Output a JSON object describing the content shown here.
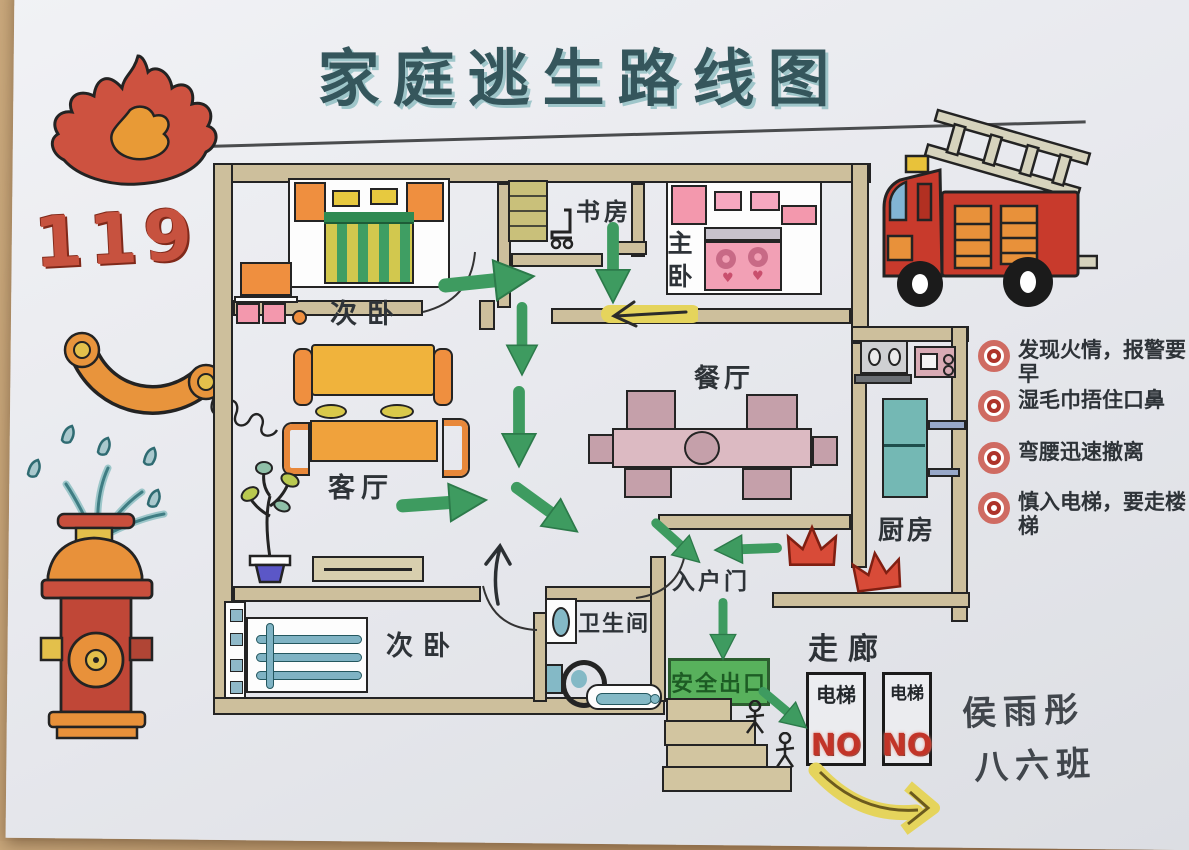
{
  "title": "家庭逃生路线图",
  "emergency_number": "119",
  "floor_plan": {
    "rooms": {
      "bedroom_top": "次卧",
      "study": "书房",
      "master_bedroom": "主卧",
      "living_room": "客厅",
      "dining_room": "餐厅",
      "kitchen": "厨房",
      "bedroom_bottom": "次卧",
      "bathroom": "卫生间",
      "entrance": "入户门",
      "corridor": "走廊"
    },
    "exit_sign": "安全出口",
    "elevators": [
      {
        "label": "电梯",
        "status": "NO"
      },
      {
        "label": "电梯",
        "status": "NO"
      }
    ]
  },
  "safety_tips": [
    "发现火情，报警要早",
    "湿毛巾捂住口鼻",
    "弯腰迅速撤离",
    "慎入电梯，要走楼梯"
  ],
  "signature": {
    "name": "侯雨彤",
    "class": "八六班"
  },
  "colors": {
    "escape_route_green": "#3e9b60",
    "highlight_yellow": "#e5d45c",
    "fire_red": "#c94f3d",
    "accent_orange": "#e8913a",
    "wall_tan": "#cdbf9c",
    "title_teal": "#35565c",
    "exit_green": "#58b15c",
    "no_red": "#c23428"
  }
}
